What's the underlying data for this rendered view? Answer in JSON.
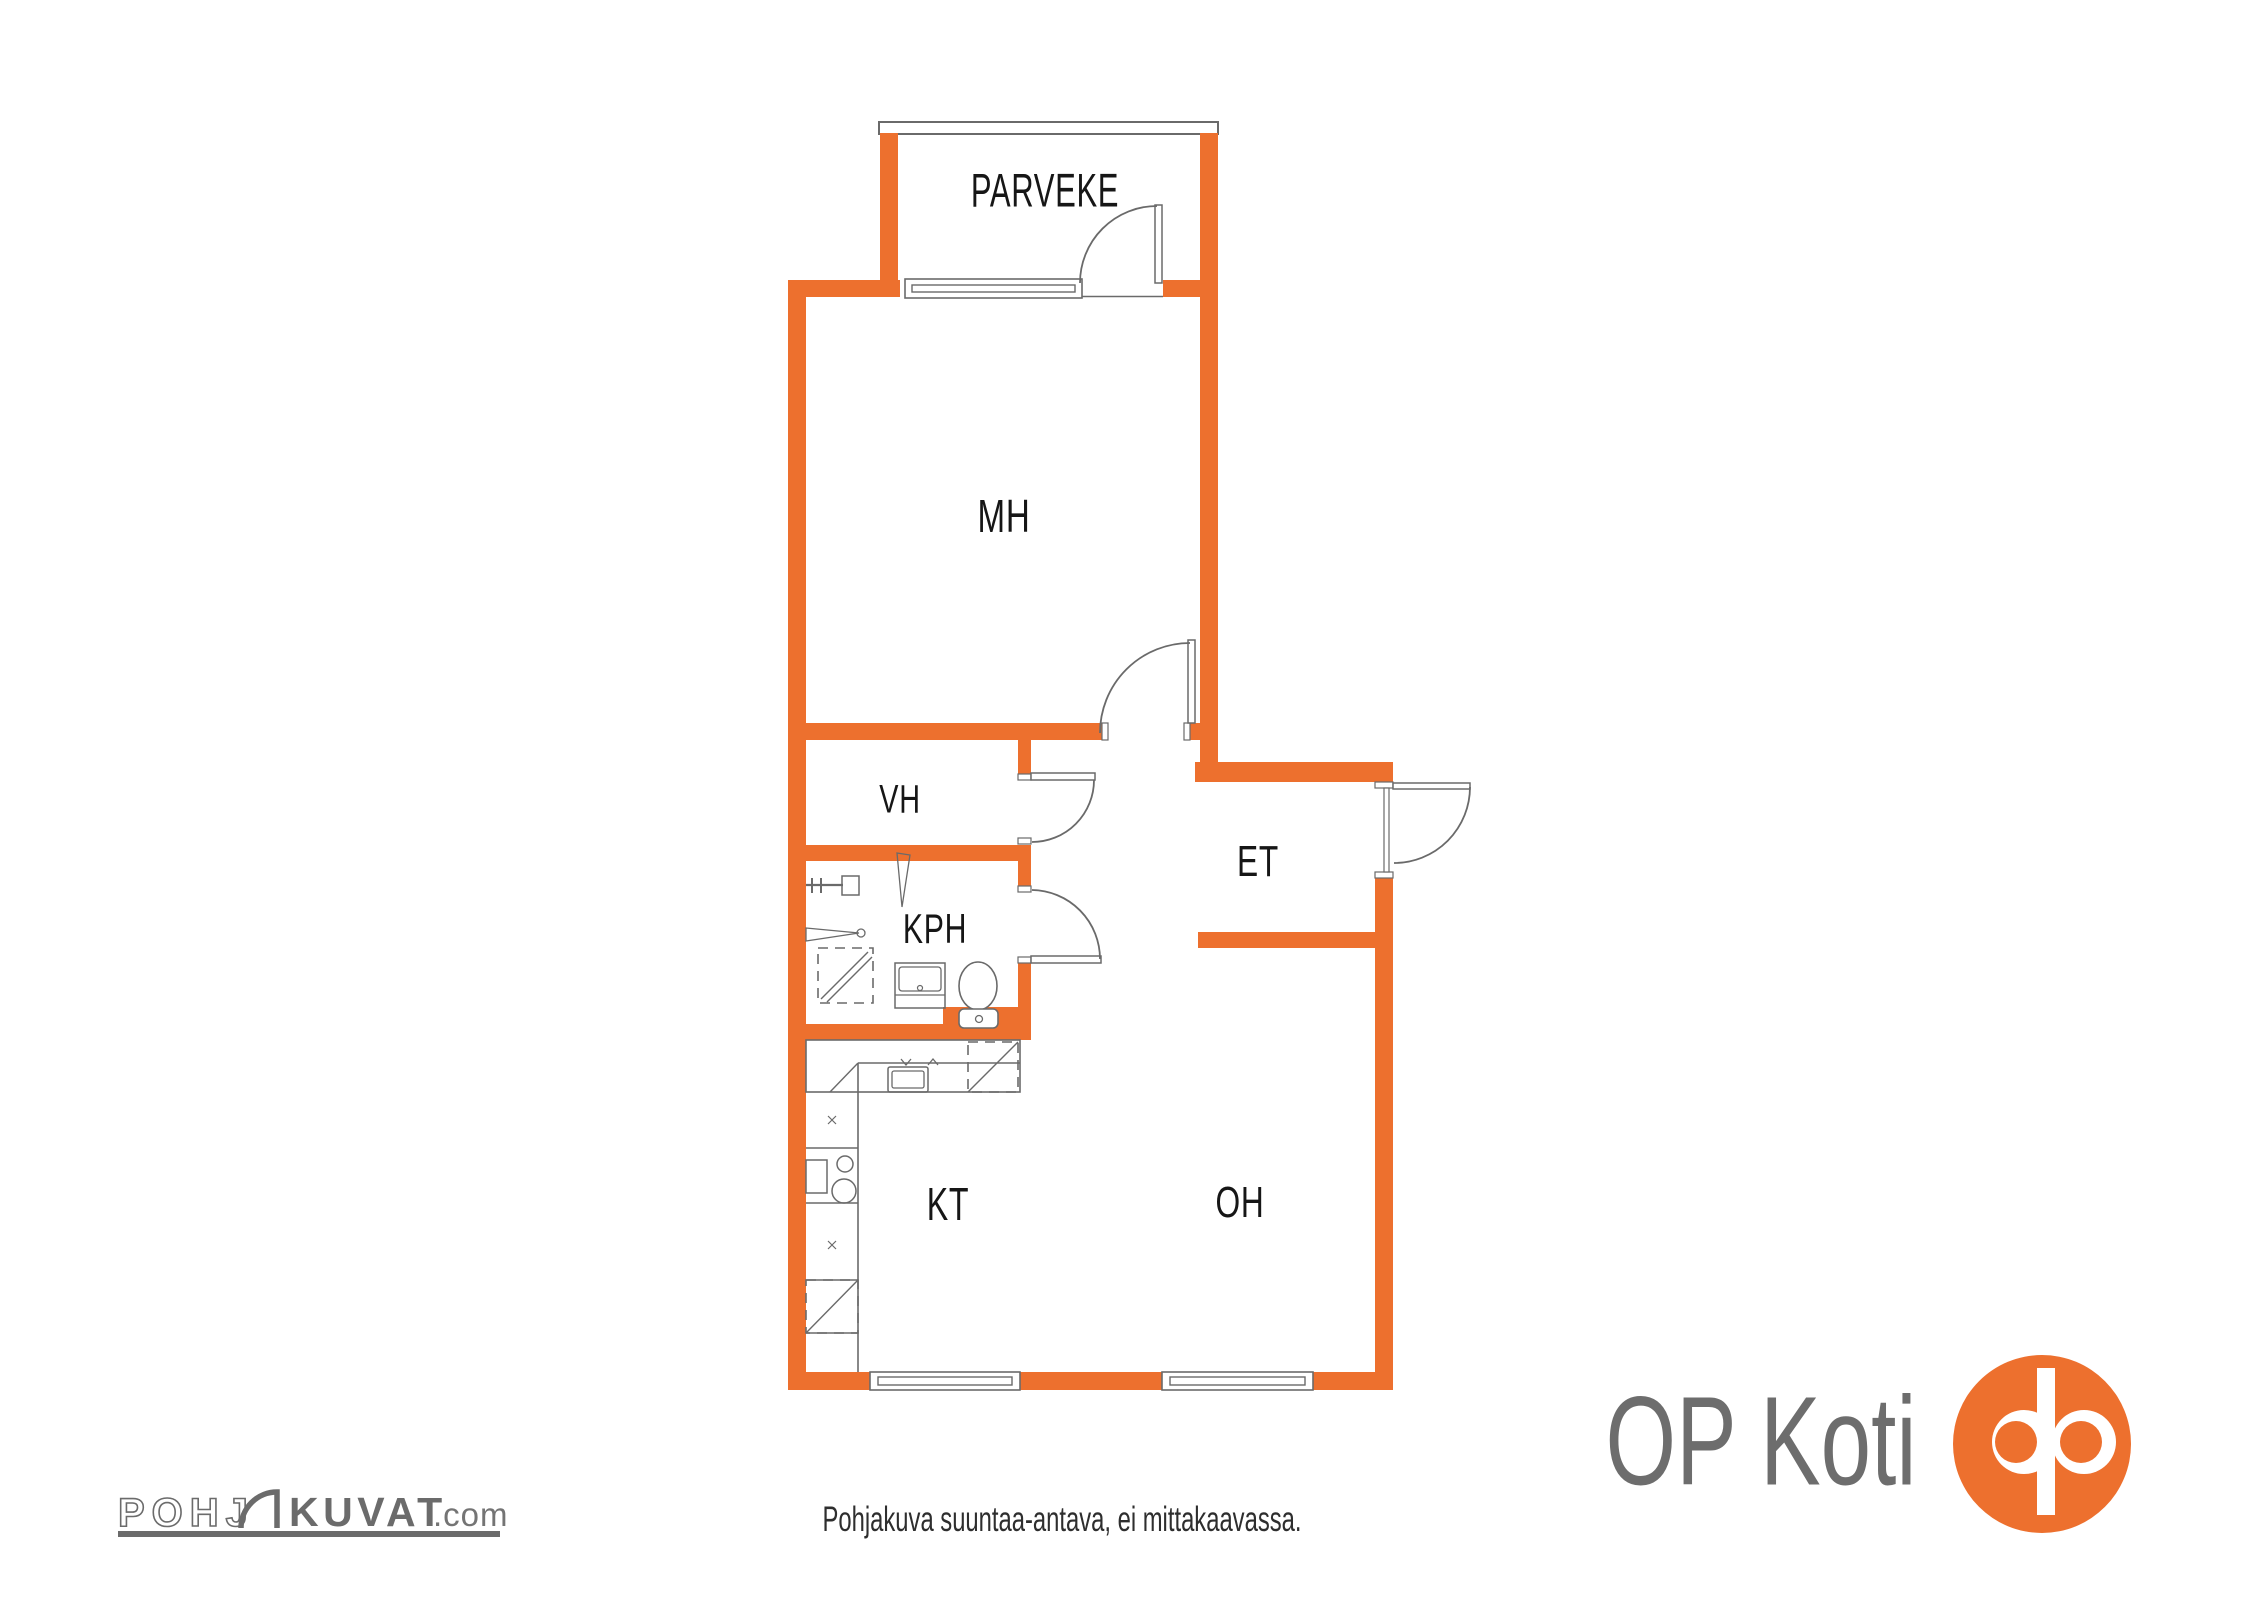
{
  "floorplan": {
    "rooms": [
      {
        "id": "parveke",
        "label": "PARVEKE"
      },
      {
        "id": "mh",
        "label": "MH"
      },
      {
        "id": "vh",
        "label": "VH"
      },
      {
        "id": "kph",
        "label": "KPH"
      },
      {
        "id": "et",
        "label": "ET"
      },
      {
        "id": "kt",
        "label": "KT"
      },
      {
        "id": "oh",
        "label": "OH"
      }
    ],
    "disclaimer": "Pohjakuva suuntaa-antava, ei mittakaavassa."
  },
  "branding": {
    "pohjakuvat_logo": {
      "prefix": "POHJ",
      "main": "KUVAT",
      "suffix": ".com"
    },
    "op_koti_logo": {
      "text": "OP Koti"
    }
  },
  "colors": {
    "wall_orange": "#ED702E",
    "fixture_gray": "#6A6A6A",
    "label_black": "#161616",
    "logo_gray": "#6B6B6B",
    "op_text_gray": "#6D6D6D"
  }
}
